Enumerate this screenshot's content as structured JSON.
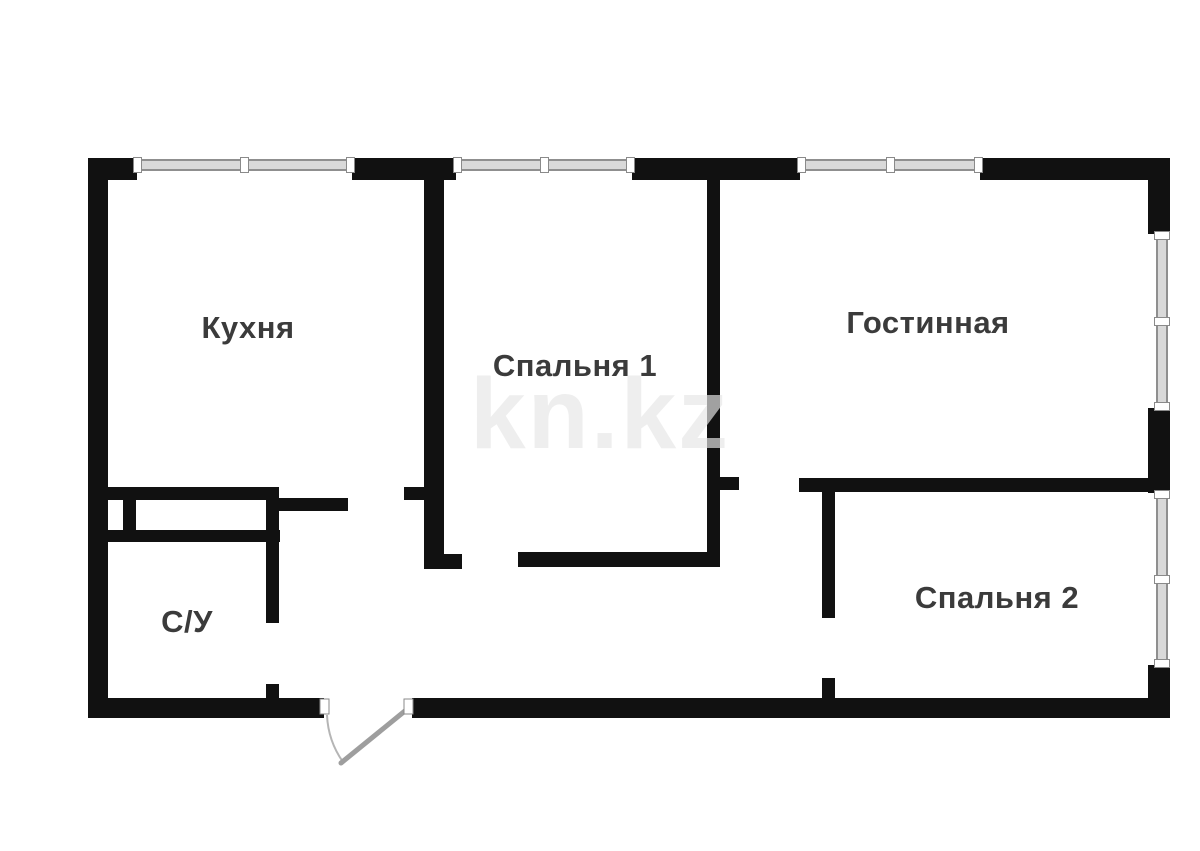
{
  "floorplan": {
    "title": "apartment-floor-plan",
    "watermark": "kn.kz",
    "rooms": [
      {
        "id": "kitchen",
        "name": "Кухня"
      },
      {
        "id": "bedroom-1",
        "name": "Спальня 1"
      },
      {
        "id": "living-room",
        "name": "Гостинная"
      },
      {
        "id": "bedroom-2",
        "name": "Спальня 2"
      },
      {
        "id": "bathroom",
        "name": "С/У"
      }
    ],
    "colors": {
      "wall": "#111111",
      "window_fill": "#d9d9d9",
      "window_frame": "#8f8f8f",
      "label": "#3b3b3b",
      "door": "#9e9e9e",
      "watermark": "#e6e6e6",
      "background": "#ffffff"
    }
  }
}
